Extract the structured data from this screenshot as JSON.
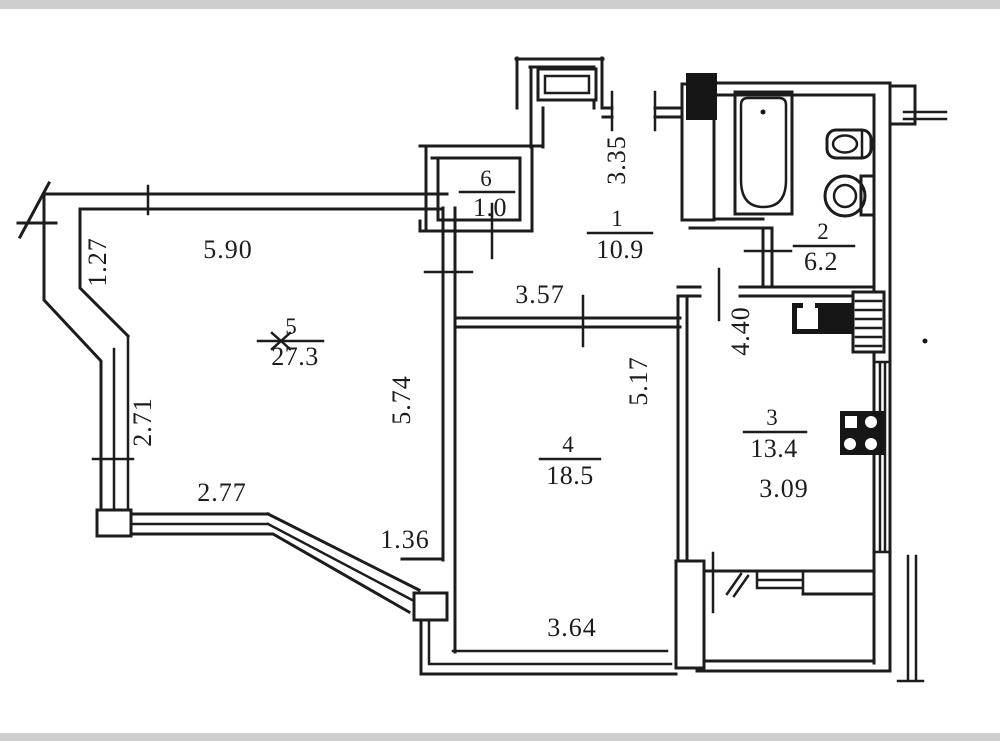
{
  "plan": {
    "type": "apartment-floor-plan",
    "rooms": [
      {
        "number": "5",
        "area": "27.3"
      },
      {
        "number": "4",
        "area": "18.5"
      },
      {
        "number": "3",
        "area": "13.4"
      },
      {
        "number": "1",
        "area": "10.9"
      },
      {
        "number": "2",
        "area": "6.2"
      },
      {
        "number": "6",
        "area": "1.0"
      }
    ],
    "dimensions": [
      {
        "value": "1.27"
      },
      {
        "value": "5.90"
      },
      {
        "value": "2.71"
      },
      {
        "value": "2.77"
      },
      {
        "value": "1.36"
      },
      {
        "value": "5.74"
      },
      {
        "value": "3.57"
      },
      {
        "value": "3.35"
      },
      {
        "value": "5.17"
      },
      {
        "value": "4.40"
      },
      {
        "value": "3.09"
      },
      {
        "value": "3.64"
      }
    ],
    "fixtures": [
      "bathtub",
      "wash-basin",
      "toilet",
      "kitchen-sink-counter",
      "stove",
      "vent-shaft",
      "duct"
    ],
    "colors": {
      "ink": "#1c1c1c",
      "paper": "#ffffff",
      "scan_edge": "#c6c6c6"
    }
  }
}
